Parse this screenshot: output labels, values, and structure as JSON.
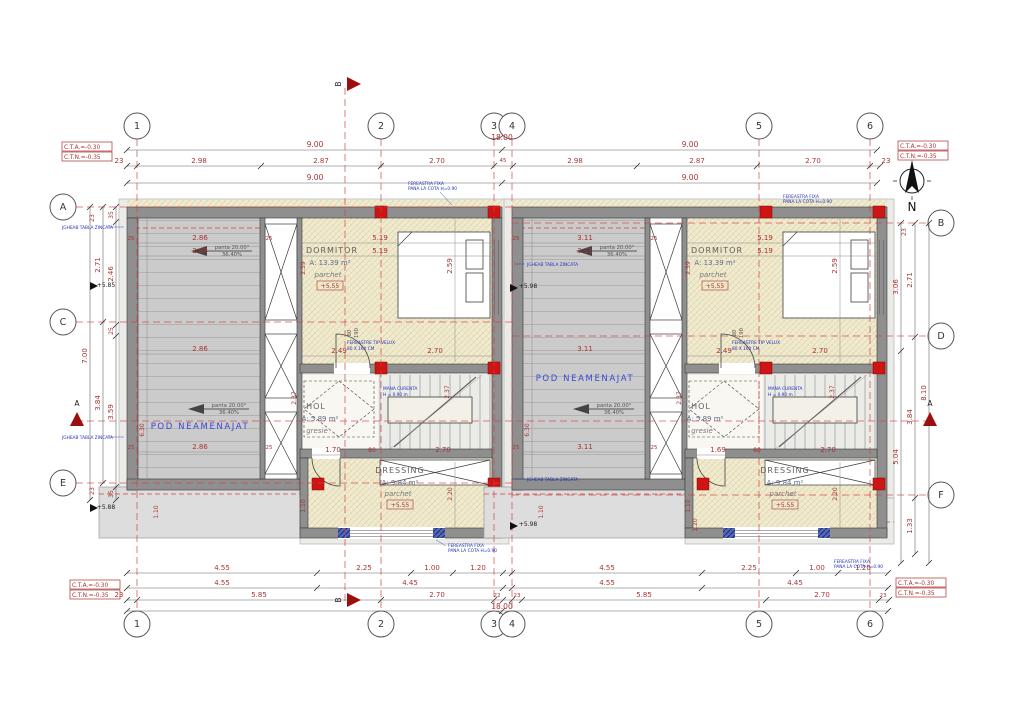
{
  "axes": {
    "top": [
      "1",
      "2",
      "3",
      "4",
      "5",
      "6"
    ],
    "left": [
      "A",
      "C",
      "E"
    ],
    "right": [
      "B",
      "D",
      "F"
    ]
  },
  "corner": {
    "cta": "C.T.A.=-0.30",
    "ctn": "C.T.N.=-0.35"
  },
  "compass": {
    "n": "N"
  },
  "sections": {
    "a": "A",
    "b": "B"
  },
  "top": {
    "total": "18.00",
    "nine": "9.00",
    "det": [
      "23",
      "2.98",
      "2.87",
      "2.70",
      "45",
      "2.98",
      "2.87",
      "2.70",
      "23"
    ]
  },
  "bottom": {
    "total": "18.00",
    "r1": [
      "4.55",
      "2.25",
      "1.00",
      "1.20"
    ],
    "r2": [
      "4.55",
      "4.45"
    ],
    "r3l": [
      "23",
      "5.85",
      "2.70",
      "22"
    ],
    "r3r": [
      "23",
      "5.85",
      "2.70",
      "23"
    ]
  },
  "left": {
    "c23": "23",
    "c35": "35",
    "v271": "2.71",
    "v246": "2.46",
    "v700": "7.00",
    "c25": "25",
    "v384": "3.84",
    "v359": "3.59",
    "lvl_top": "+5.85",
    "lvl_bot": "+5.88"
  },
  "right": {
    "c23": "23",
    "v306": "3.06",
    "v271": "2.71",
    "v810": "8.10",
    "v384": "3.84",
    "v504": "5.04",
    "v133": "1.33"
  },
  "pod": {
    "name": "POD NEAMENAJAT",
    "panta": "panta 20.00°",
    "pct": "36.40%",
    "h": "6.30"
  },
  "rooms": {
    "dorm": {
      "name": "DORMITOR",
      "area": "A: 13.39 m²",
      "floor": "parchet",
      "lvl": "+5.55"
    },
    "hol": {
      "name": "HOL",
      "area": "A: 5.89 m²",
      "floor": "gresie"
    },
    "dres": {
      "name": "DRESSING",
      "area": "A: 9.84 m²",
      "floor": "parchet",
      "lvl": "+5.55"
    }
  },
  "u1": {
    "pod": "2.86",
    "dw": "5.19",
    "dh": "2.59",
    "h1": "2.49",
    "h2": "2.70",
    "h3": "2.37",
    "d1": "1.70",
    "d2": "80",
    "d3": "2.70",
    "d4": "2.20",
    "d5": "1.10",
    "slab": "1.10"
  },
  "u2": {
    "pod": "3.11",
    "dw": "5.19",
    "dh": "2.59",
    "h1": "2.49",
    "h2": "2.70",
    "h3": "2.37",
    "d1": "1.69",
    "d2": "80",
    "d3": "2.70",
    "d4": "2.20",
    "d5": "1.10",
    "slab": "1.10",
    "d6": "1.20"
  },
  "w": {
    "w25": "25",
    "w10": "10"
  },
  "lvl": {
    "p598": "+5.98"
  },
  "ann": {
    "fer1": "FEREASTRA FIXA",
    "fer2": "PANA LA COTA H=0.90",
    "vel1": "FEREASTRE TIP VELUX",
    "vel2": "80 X 160 CM",
    "man1": "MANA CURENTA",
    "man2": "H = 0.90 m",
    "jgh": "JGHEAB TABLA ZINCATA",
    "door_w": "80",
    "door_h": "190"
  }
}
